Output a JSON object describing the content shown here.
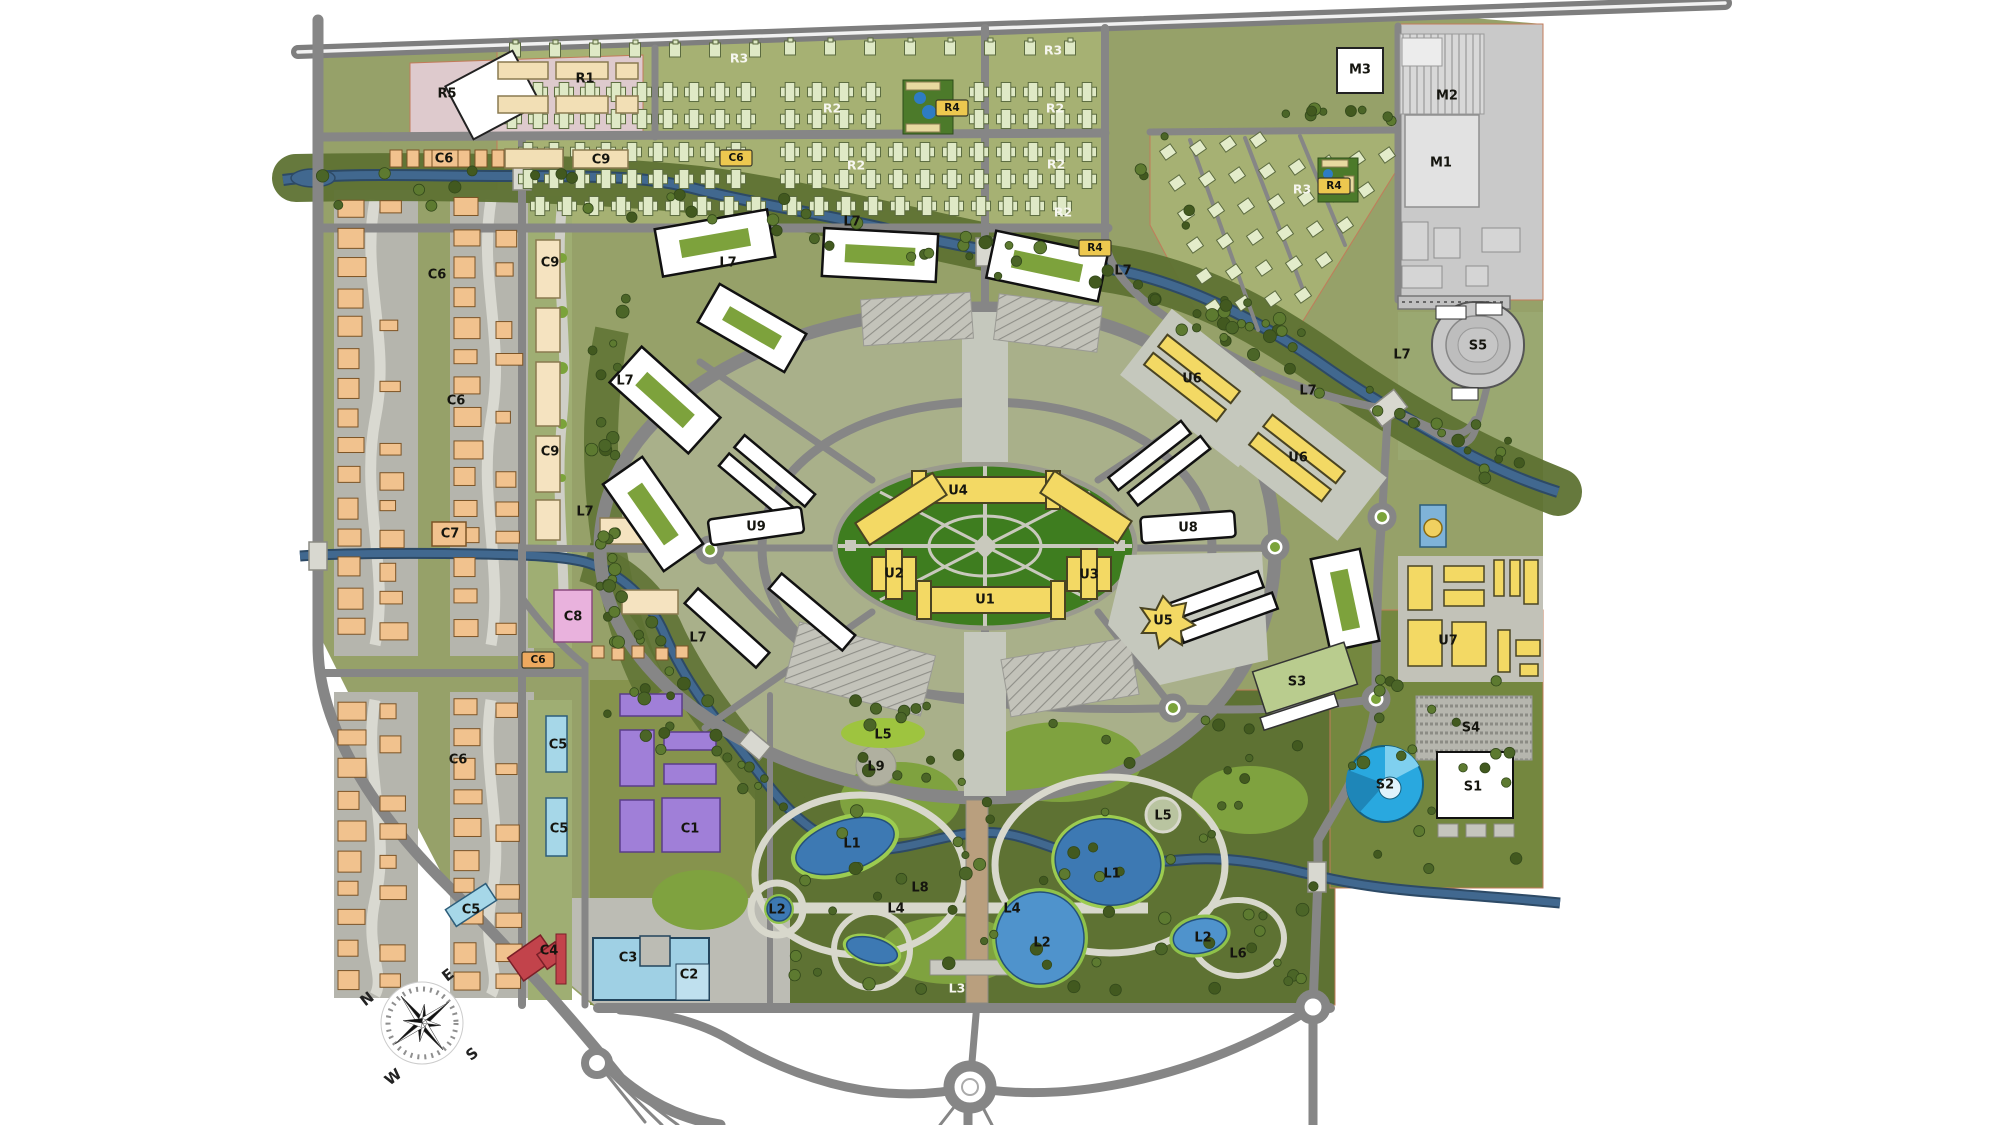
{
  "map": {
    "name": "urban-district-masterplan",
    "compass": {
      "n": "N",
      "e": "E",
      "s": "S",
      "w": "W"
    }
  },
  "palette": {
    "land_olive": "#96a169",
    "housing_green": "#a6b173",
    "park_green": "#5e7233",
    "inner_core_green": "#3e7d1f",
    "campus_sage": "#a9b08a",
    "road_gray": "#868686",
    "river_blue": "#41688f",
    "lake_blue": "#3d79b3",
    "yellow_building": "#f3d964",
    "orange_building": "#f1c28e",
    "tan_building": "#f2dfb5",
    "purple_building": "#a07fd8",
    "blue_building": "#a6d7e8",
    "red_building": "#c2434b",
    "pink_zone": "#decacd",
    "pink_building": "#e9b2dd",
    "industry_gray": "#c9c9c9",
    "arena_blue": "#29a8df",
    "house_fill": "#dfe9c6"
  },
  "labels": [
    {
      "text": "R5",
      "x": 447,
      "y": 94,
      "style": "dark"
    },
    {
      "text": "R1",
      "x": 585,
      "y": 79,
      "style": "dark"
    },
    {
      "text": "C9",
      "x": 601,
      "y": 160,
      "style": "dark"
    },
    {
      "text": "C6",
      "x": 444,
      "y": 159,
      "style": "dark"
    },
    {
      "text": "C6",
      "x": 736,
      "y": 158,
      "style": "chip_yellow"
    },
    {
      "text": "R3",
      "x": 739,
      "y": 58,
      "style": "light"
    },
    {
      "text": "R3",
      "x": 1053,
      "y": 50,
      "style": "light"
    },
    {
      "text": "R2",
      "x": 832,
      "y": 108,
      "style": "light"
    },
    {
      "text": "R2",
      "x": 1055,
      "y": 108,
      "style": "light"
    },
    {
      "text": "R2",
      "x": 856,
      "y": 165,
      "style": "light"
    },
    {
      "text": "R2",
      "x": 1056,
      "y": 164,
      "style": "light"
    },
    {
      "text": "R2",
      "x": 1063,
      "y": 212,
      "style": "light"
    },
    {
      "text": "R4",
      "x": 952,
      "y": 108,
      "style": "chip_yellow"
    },
    {
      "text": "R4",
      "x": 1095,
      "y": 248,
      "style": "chip_yellow"
    },
    {
      "text": "R3",
      "x": 1302,
      "y": 189,
      "style": "light"
    },
    {
      "text": "R4",
      "x": 1334,
      "y": 186,
      "style": "chip_yellow"
    },
    {
      "text": "M3",
      "x": 1360,
      "y": 70,
      "style": "dark"
    },
    {
      "text": "M2",
      "x": 1447,
      "y": 96,
      "style": "dark"
    },
    {
      "text": "M1",
      "x": 1441,
      "y": 163,
      "style": "dark"
    },
    {
      "text": "S5",
      "x": 1478,
      "y": 346,
      "style": "dark"
    },
    {
      "text": "C6",
      "x": 437,
      "y": 275,
      "style": "dark"
    },
    {
      "text": "C9",
      "x": 550,
      "y": 263,
      "style": "dark"
    },
    {
      "text": "C6",
      "x": 456,
      "y": 401,
      "style": "dark"
    },
    {
      "text": "C9",
      "x": 550,
      "y": 452,
      "style": "dark"
    },
    {
      "text": "C7",
      "x": 450,
      "y": 534,
      "style": "dark"
    },
    {
      "text": "C8",
      "x": 573,
      "y": 617,
      "style": "dark"
    },
    {
      "text": "C6",
      "x": 538,
      "y": 660,
      "style": "chip_orange"
    },
    {
      "text": "C6",
      "x": 458,
      "y": 760,
      "style": "dark"
    },
    {
      "text": "C5",
      "x": 558,
      "y": 745,
      "style": "dark"
    },
    {
      "text": "C5",
      "x": 559,
      "y": 829,
      "style": "dark"
    },
    {
      "text": "C1",
      "x": 690,
      "y": 829,
      "style": "dark"
    },
    {
      "text": "C5",
      "x": 471,
      "y": 910,
      "style": "dark"
    },
    {
      "text": "C4",
      "x": 549,
      "y": 951,
      "style": "dark"
    },
    {
      "text": "C3",
      "x": 628,
      "y": 958,
      "style": "dark"
    },
    {
      "text": "C2",
      "x": 689,
      "y": 975,
      "style": "dark"
    },
    {
      "text": "L7",
      "x": 852,
      "y": 222,
      "style": "dark"
    },
    {
      "text": "L7",
      "x": 728,
      "y": 263,
      "style": "dark"
    },
    {
      "text": "L7",
      "x": 625,
      "y": 381,
      "style": "dark"
    },
    {
      "text": "L7",
      "x": 585,
      "y": 512,
      "style": "dark"
    },
    {
      "text": "L7",
      "x": 698,
      "y": 638,
      "style": "dark"
    },
    {
      "text": "L7",
      "x": 1123,
      "y": 271,
      "style": "dark"
    },
    {
      "text": "L7",
      "x": 1308,
      "y": 391,
      "style": "dark"
    },
    {
      "text": "L7",
      "x": 1402,
      "y": 355,
      "style": "dark"
    },
    {
      "text": "U9",
      "x": 756,
      "y": 527,
      "style": "dark"
    },
    {
      "text": "U8",
      "x": 1188,
      "y": 528,
      "style": "dark"
    },
    {
      "text": "U4",
      "x": 958,
      "y": 491,
      "style": "dark"
    },
    {
      "text": "U2",
      "x": 894,
      "y": 574,
      "style": "dark"
    },
    {
      "text": "U3",
      "x": 1089,
      "y": 575,
      "style": "dark"
    },
    {
      "text": "U1",
      "x": 985,
      "y": 600,
      "style": "dark"
    },
    {
      "text": "U5",
      "x": 1163,
      "y": 621,
      "style": "dark"
    },
    {
      "text": "U6",
      "x": 1192,
      "y": 379,
      "style": "dark"
    },
    {
      "text": "U6",
      "x": 1298,
      "y": 458,
      "style": "dark"
    },
    {
      "text": "U7",
      "x": 1448,
      "y": 641,
      "style": "dark"
    },
    {
      "text": "S3",
      "x": 1297,
      "y": 682,
      "style": "dark"
    },
    {
      "text": "S4",
      "x": 1471,
      "y": 728,
      "style": "dark"
    },
    {
      "text": "S2",
      "x": 1385,
      "y": 785,
      "style": "dark"
    },
    {
      "text": "S1",
      "x": 1473,
      "y": 787,
      "style": "dark"
    },
    {
      "text": "L5",
      "x": 883,
      "y": 735,
      "style": "dark"
    },
    {
      "text": "L9",
      "x": 876,
      "y": 767,
      "style": "dark"
    },
    {
      "text": "L1",
      "x": 852,
      "y": 844,
      "style": "dark"
    },
    {
      "text": "L1",
      "x": 1112,
      "y": 874,
      "style": "dark"
    },
    {
      "text": "L2",
      "x": 777,
      "y": 910,
      "style": "dark"
    },
    {
      "text": "L8",
      "x": 920,
      "y": 888,
      "style": "dark"
    },
    {
      "text": "L4",
      "x": 896,
      "y": 909,
      "style": "dark"
    },
    {
      "text": "L4",
      "x": 1012,
      "y": 909,
      "style": "dark"
    },
    {
      "text": "L2",
      "x": 1042,
      "y": 943,
      "style": "dark"
    },
    {
      "text": "L2",
      "x": 1203,
      "y": 938,
      "style": "dark"
    },
    {
      "text": "L6",
      "x": 1238,
      "y": 954,
      "style": "dark"
    },
    {
      "text": "L5",
      "x": 1163,
      "y": 816,
      "style": "dark"
    },
    {
      "text": "L3",
      "x": 957,
      "y": 988,
      "style": "light"
    }
  ]
}
